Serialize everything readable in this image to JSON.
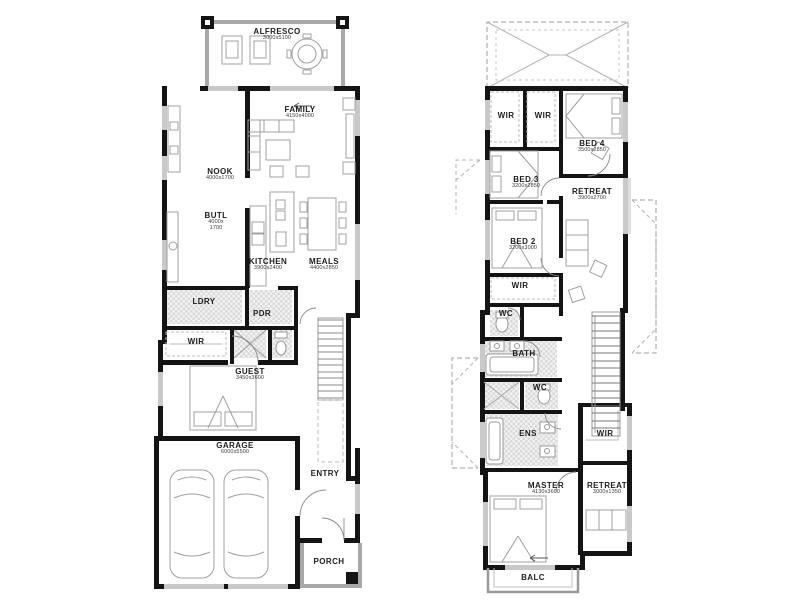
{
  "page": {
    "background": "#ffffff"
  },
  "colors": {
    "wall": "#141414",
    "light_wall": "#a8a8a8",
    "window": "#c9c9c9",
    "tile": "#d9d9d9",
    "roof_dash": "#b3b3b3",
    "furniture": "#a0a0a0"
  },
  "plans": {
    "ground": {
      "rooms": {
        "alfresco": {
          "label": "ALFRESCO",
          "dims": "3000x5100"
        },
        "family": {
          "label": "FAMILY",
          "dims": "4150x4000"
        },
        "nook": {
          "label": "NOOK",
          "dims": "4000x1700"
        },
        "butl": {
          "label": "BUTL",
          "dims": "4000x 1700"
        },
        "kitchen": {
          "label": "KITCHEN",
          "dims": "3900x2400"
        },
        "meals": {
          "label": "MEALS",
          "dims": "4400x2850"
        },
        "ldry": {
          "label": "LDRY"
        },
        "pdr": {
          "label": "PDR"
        },
        "wir": {
          "label": "WIR"
        },
        "guest": {
          "label": "GUEST",
          "dims": "3450x3600"
        },
        "garage": {
          "label": "GARAGE",
          "dims": "6000x5500"
        },
        "entry": {
          "label": "ENTRY"
        },
        "porch": {
          "label": "PORCH"
        }
      }
    },
    "first": {
      "rooms": {
        "wir_a": {
          "label": "WIR"
        },
        "wir_b": {
          "label": "WIR"
        },
        "bed4": {
          "label": "BED 4",
          "dims": "3500x2850"
        },
        "bed3": {
          "label": "BED 3",
          "dims": "3200x2850"
        },
        "retreat_upper": {
          "label": "RETREAT",
          "dims": "3900x2700"
        },
        "bed2": {
          "label": "BED 2",
          "dims": "3200x3000"
        },
        "wir_mid": {
          "label": "WIR"
        },
        "wc_a": {
          "label": "WC"
        },
        "bath": {
          "label": "BATH"
        },
        "wc_b": {
          "label": "WC"
        },
        "ens": {
          "label": "ENS"
        },
        "wir_right": {
          "label": "WIR"
        },
        "master": {
          "label": "MASTER",
          "dims": "4130x3600"
        },
        "retreat_lower": {
          "label": "RETREAT",
          "dims": "3000x1350"
        },
        "balc": {
          "label": "BALC"
        }
      }
    }
  }
}
